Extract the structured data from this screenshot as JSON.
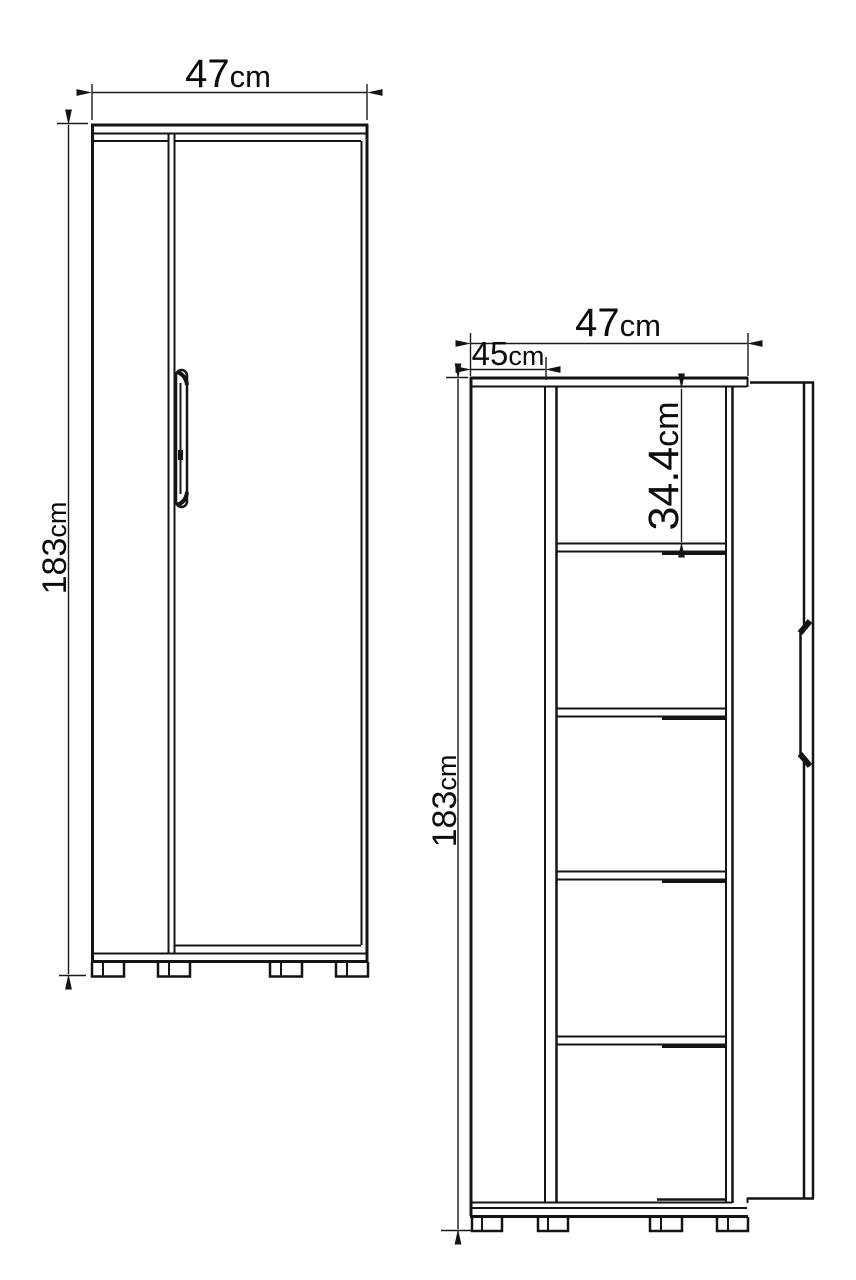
{
  "palette": {
    "background": "#ffffff",
    "line": "#141414",
    "text": "#0c0c0c"
  },
  "views": {
    "closed": {
      "width": {
        "value": "47",
        "unit": "cm"
      },
      "height": {
        "value": "183",
        "unit": "cm"
      }
    },
    "open": {
      "width": {
        "value": "47",
        "unit": "cm"
      },
      "depth": {
        "value": "45",
        "unit": "cm"
      },
      "height": {
        "value": "183",
        "unit": "cm"
      },
      "shelf_spacing": {
        "value": "34.4",
        "unit": "cm"
      }
    }
  }
}
